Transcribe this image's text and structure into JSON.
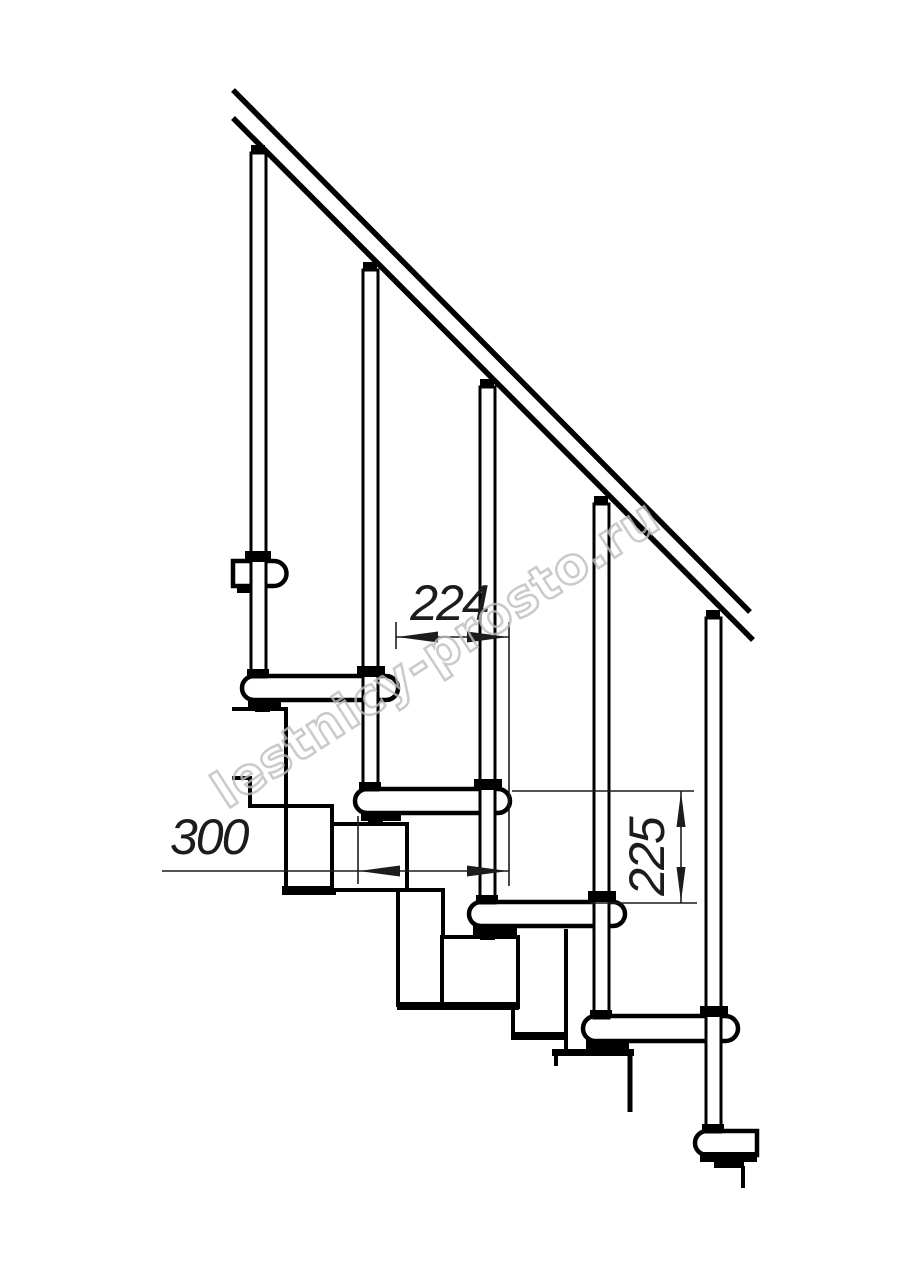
{
  "page": {
    "background_color": "#ffffff",
    "width_px": 914,
    "height_px": 1280
  },
  "drawing": {
    "kind": "modular-staircase-side-elevation",
    "colors": {
      "line": "#000000",
      "dimension": "#1c1c1c",
      "watermark": "#bdbdbd",
      "fill": "#ffffff"
    },
    "watermark": {
      "text": "lestnicy-prosto.ru"
    },
    "dimensions": {
      "overlap": {
        "label": "224",
        "orientation": "horizontal"
      },
      "depth": {
        "label": "300",
        "orientation": "horizontal"
      },
      "rise": {
        "label": "225",
        "orientation": "vertical"
      }
    },
    "counts": {
      "balusters": 5,
      "full_treads": 4,
      "partial_treads": 2
    }
  }
}
